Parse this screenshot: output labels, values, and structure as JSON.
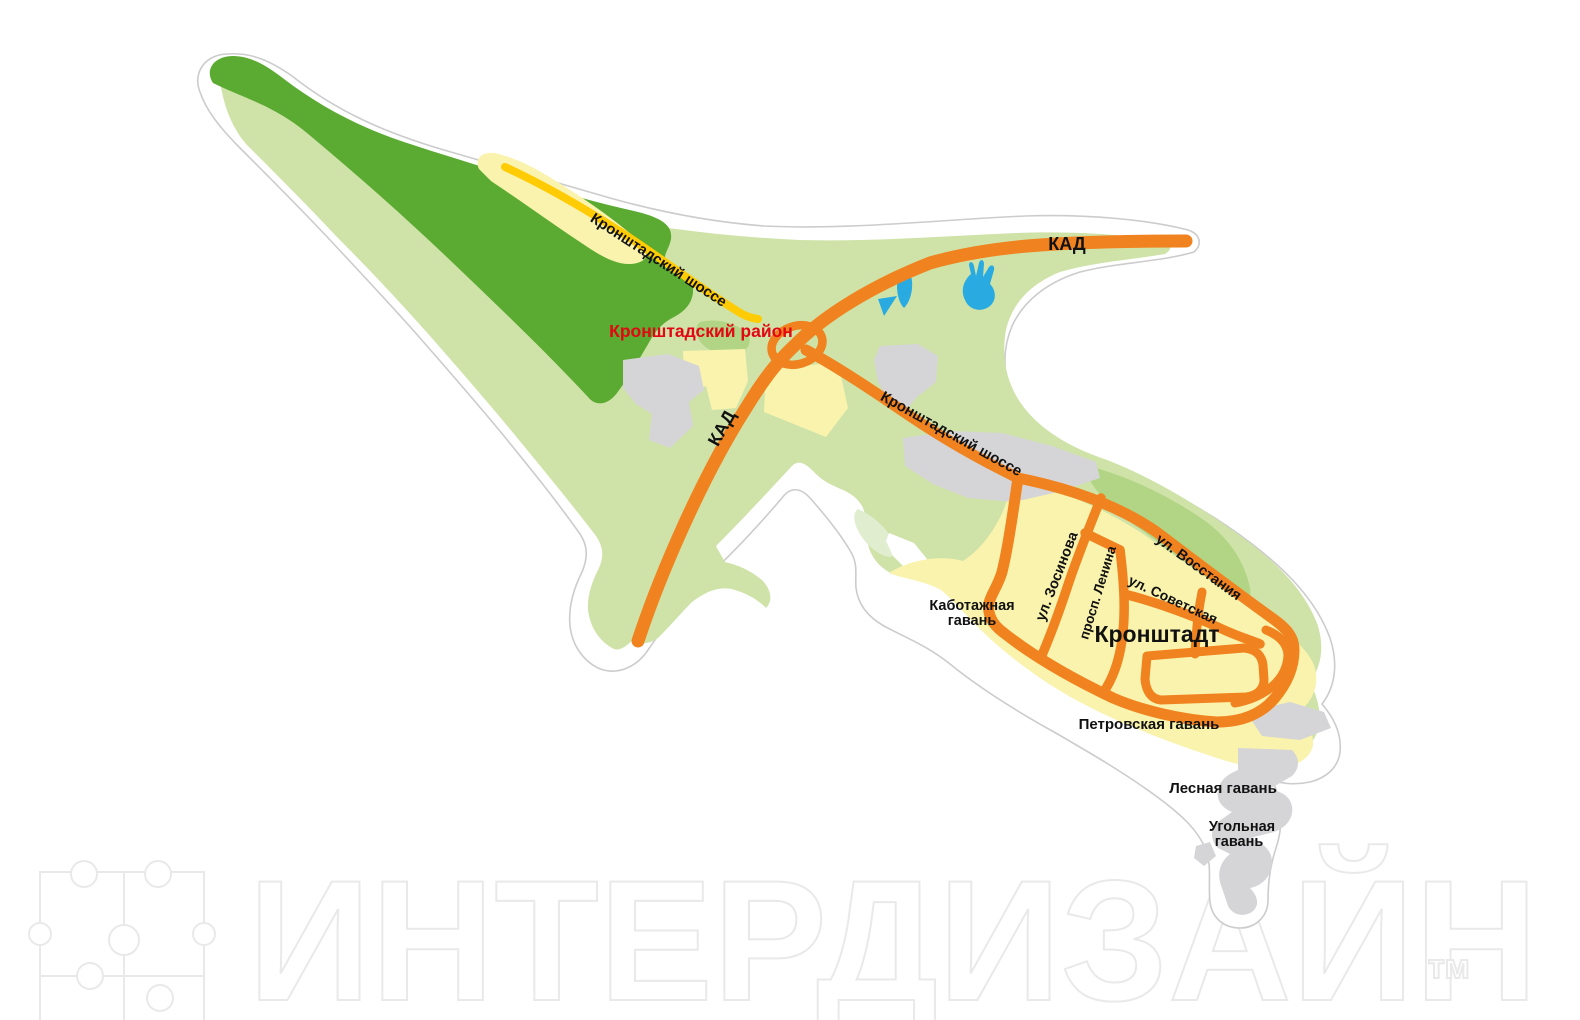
{
  "labels": {
    "kad_north": "КАД",
    "kad_south": "КАД",
    "shosse_nw": "Кронштадский шоссе",
    "shosse_central": "Кронштадский шоссе",
    "district": "Кронштадский район",
    "city": "Кронштадт",
    "street_zosinova": "ул. Зосинова",
    "street_lenina": "просп. Ленина",
    "street_sovetskaya": "ул. Советская",
    "street_vosstaniya": "ул. Восстания",
    "harbor_kabotazhnaya_line1": "Каботажная",
    "harbor_kabotazhnaya_line2": "гавань",
    "harbor_petrovskaya": "Петровская гавань",
    "harbor_lesnaya": "Лесная гавань",
    "harbor_ugolnaya_line1": "Угольная",
    "harbor_ugolnaya_line2": "гавань"
  },
  "watermark": {
    "text": "ИНТЕРДИЗАЙН",
    "tm": "тм"
  },
  "colors": {
    "land_light": "#cfe3a9",
    "land_medium": "#b2d585",
    "land_pale": "#e0edcf",
    "forest_dark": "#5baa31",
    "urban_yellow": "#faf3ad",
    "industrial_gray": "#d5d5d7",
    "water_blue": "#29abe2",
    "road_orange": "#f0831f",
    "road_yellow": "#ffcb05",
    "district_red": "#e30613",
    "island_outline": "#cccccc",
    "label_black": "#111111",
    "watermark_gray": "#e9e9e9"
  }
}
